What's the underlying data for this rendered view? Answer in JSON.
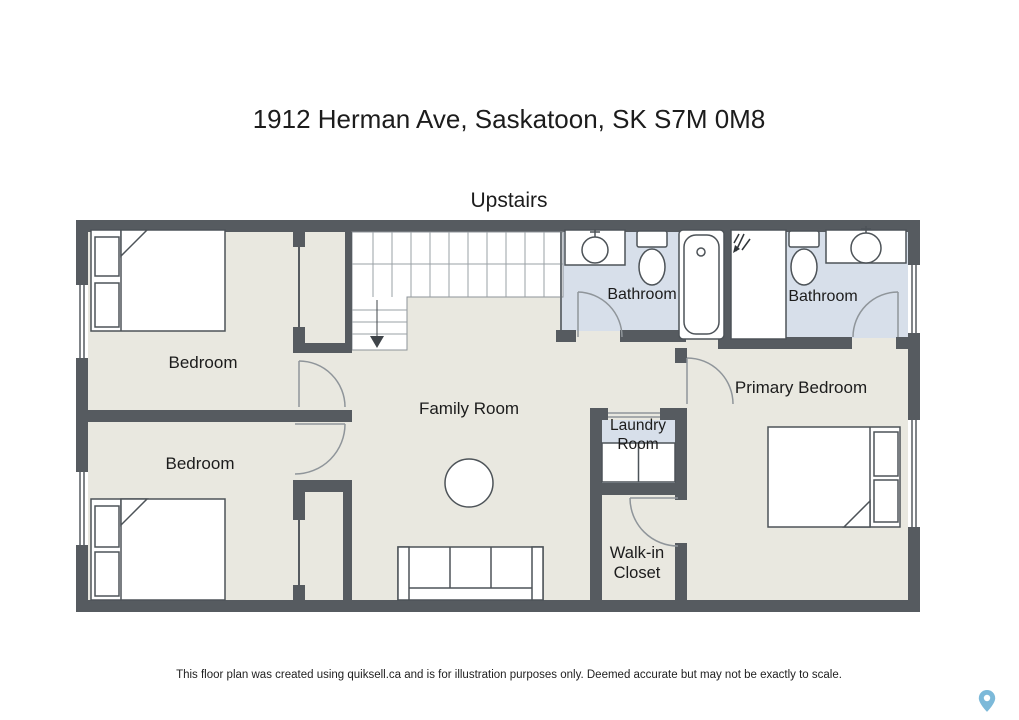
{
  "page": {
    "title": "1912 Herman Ave, Saskatoon, SK S7M 0M8",
    "floor_label": "Upstairs",
    "disclaimer": "This floor plan was created using quiksell.ca and is for illustration purposes only. Deemed accurate but may not be exactly to scale."
  },
  "rooms": {
    "bedroom_top": {
      "label": "Bedroom"
    },
    "bedroom_bottom": {
      "label": "Bedroom"
    },
    "family_room": {
      "label": "Family Room"
    },
    "bathroom_left": {
      "label": "Bathroom"
    },
    "bathroom_right": {
      "label": "Bathroom"
    },
    "primary_bedroom": {
      "label": "Primary Bedroom"
    },
    "laundry_room": {
      "line1": "Laundry",
      "line2": "Room"
    },
    "walk_in_closet": {
      "line1": "Walk-in",
      "line2": "Closet"
    }
  },
  "icons": {
    "bottom_right": "map-pin-icon"
  },
  "colors": {
    "wall": "#565b60",
    "floor": "#e9e8e0",
    "wet_floor": "#d7dfea",
    "fixture_fill": "#ffffff",
    "fixture_outline": "#4d5358",
    "door_arc": "#8f959a",
    "map_pin": "#7cb9d9"
  }
}
